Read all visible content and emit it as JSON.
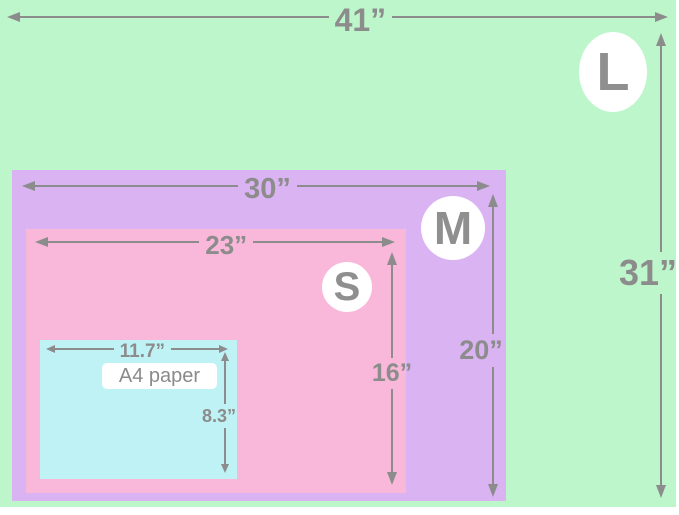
{
  "colors": {
    "size_l_fill": "#bdf6ca",
    "size_m_fill": "#d9b3f2",
    "size_s_fill": "#f9b8d9",
    "a4_fill": "#bff2f5",
    "dim_gray": "#8c8c8c",
    "badge_fill": "#ffffff"
  },
  "icons": {
    "arrowhead": "css-triangle"
  },
  "sizes": {
    "l": {
      "badge": "L",
      "width": "41”",
      "height": "31”"
    },
    "m": {
      "badge": "M",
      "width": "30”",
      "height": "20”"
    },
    "s": {
      "badge": "S",
      "width": "23”",
      "height": "16”"
    },
    "a4": {
      "name": "A4 paper",
      "width": "11.7”",
      "height": "8.3”"
    }
  }
}
